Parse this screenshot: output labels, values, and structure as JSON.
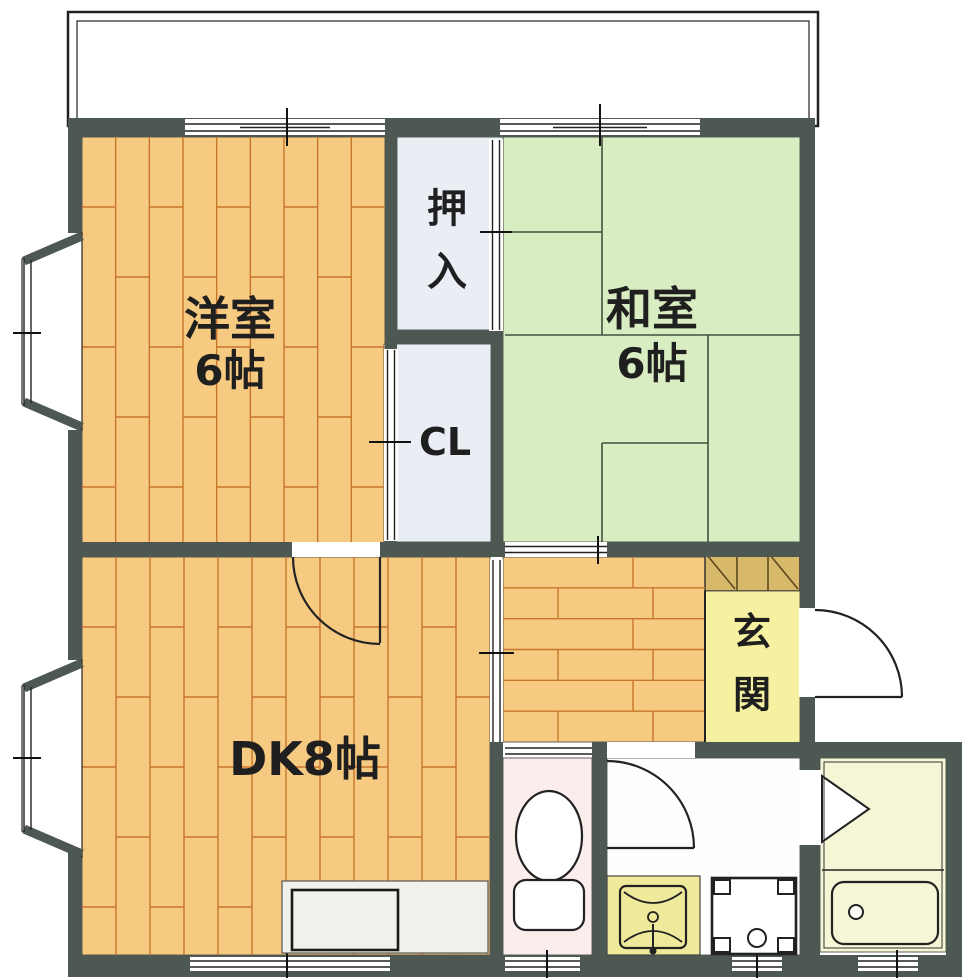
{
  "plan": {
    "rooms": {
      "western": {
        "name": "洋室",
        "size": "6帖"
      },
      "japanese": {
        "name": "和室",
        "size": "6帖"
      },
      "dk": {
        "name": "DK8帖"
      },
      "oshiire": {
        "name": "押入",
        "chars": [
          "押",
          "入"
        ]
      },
      "closet": {
        "name": "CL"
      },
      "genkan": {
        "name": "玄関",
        "chars": [
          "玄",
          "関"
        ]
      }
    }
  },
  "colors": {
    "wall": "#4e5852",
    "wood": "#f6ca80",
    "wood_line": "#c8762c",
    "tatami": "#d9edc2",
    "tatami_line": "#42503f",
    "closet": "#e9edf4",
    "genkan": "#f6f1a1",
    "cabinet": "#d8b86a",
    "toilet": "#faedeb",
    "washroom": "#fefefc",
    "bath": "#f4f6d6",
    "vanity": "#efe99c"
  }
}
